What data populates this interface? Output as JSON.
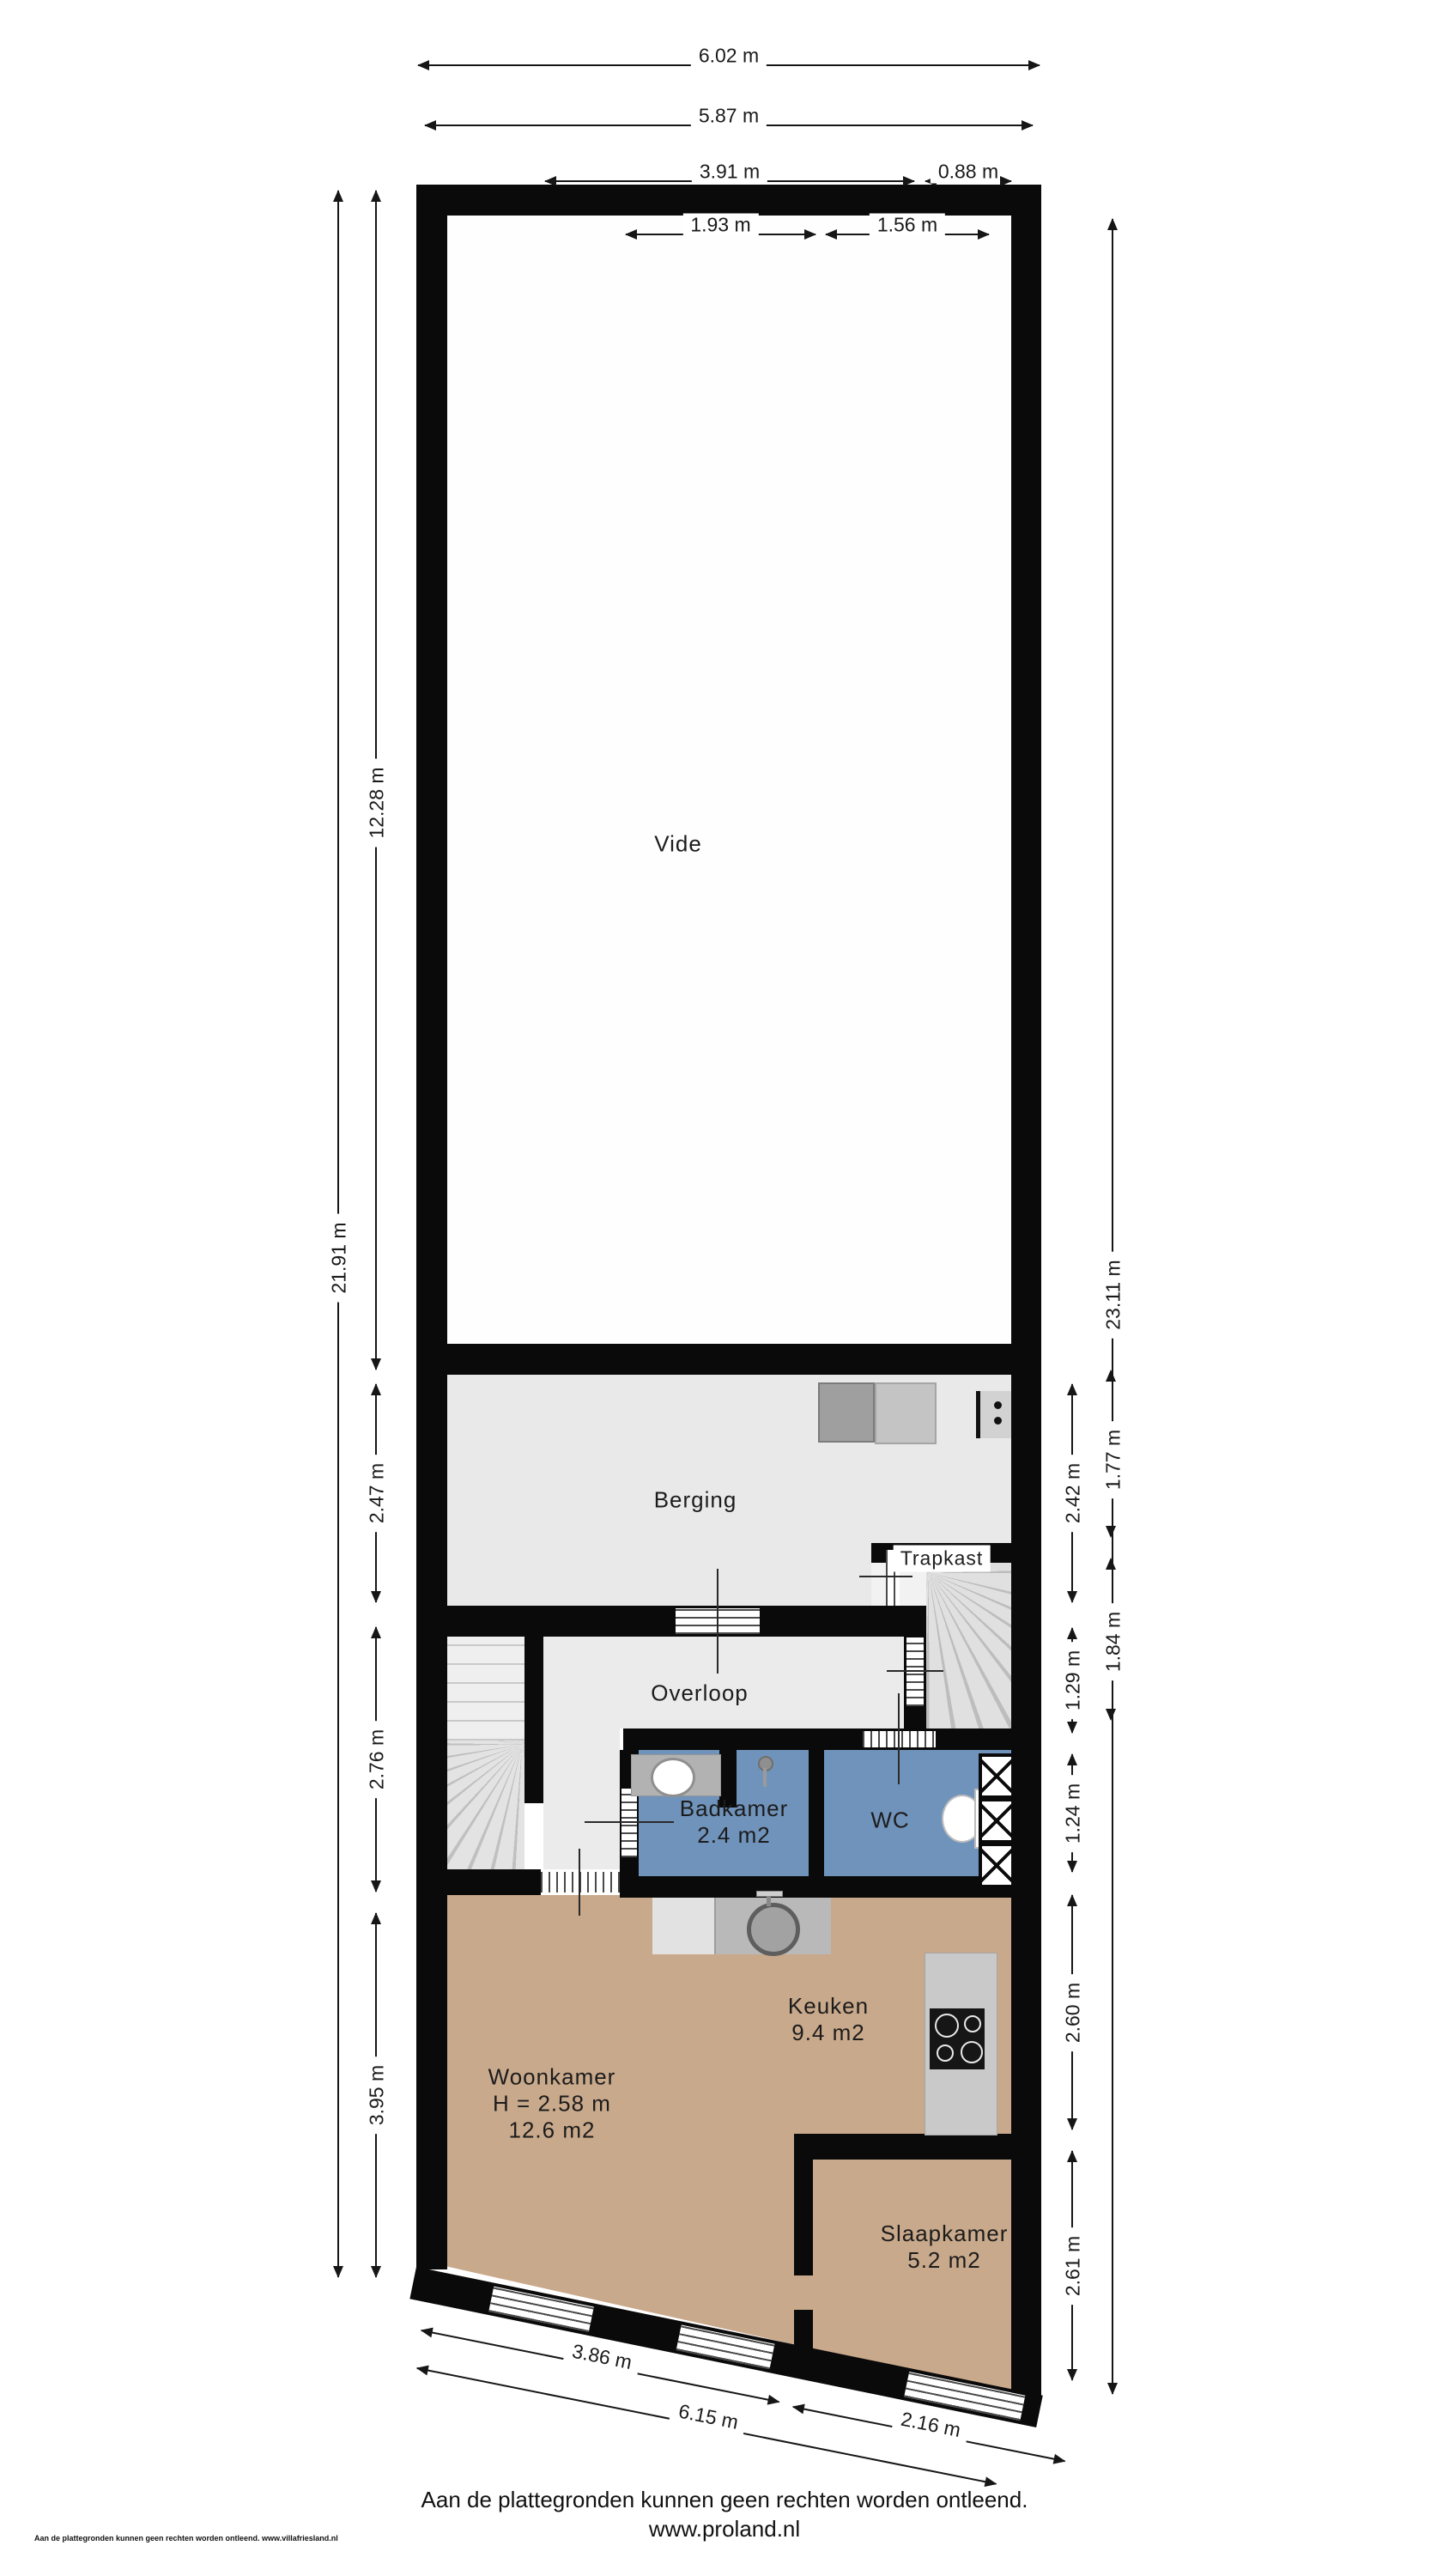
{
  "rooms": {
    "vide": {
      "name": "Vide"
    },
    "berging": {
      "name": "Berging"
    },
    "trapkast": {
      "name": "Trapkast"
    },
    "overloop": {
      "name": "Overloop"
    },
    "badkamer": {
      "name": "Badkamer",
      "area": "2.4 m2"
    },
    "wc": {
      "name": "WC"
    },
    "keuken": {
      "name": "Keuken",
      "area": "9.4 m2"
    },
    "woonkamer": {
      "name": "Woonkamer",
      "ceiling_height": "H = 2.58 m",
      "area": "12.6 m2"
    },
    "slaapkamer": {
      "name": "Slaapkamer",
      "area": "5.2 m2"
    }
  },
  "dimensions": {
    "top": {
      "d1": "6.02 m",
      "d2": "5.87 m",
      "d3": "3.91 m",
      "d4": "0.88 m",
      "d5": "1.93 m",
      "d6": "1.56 m"
    },
    "left": {
      "total": "21.91 m",
      "vide": "12.28 m",
      "berging": "2.47 m",
      "overloop": "2.76 m",
      "woonkamer": "3.95 m"
    },
    "right": {
      "total": "23.11 m",
      "seg1": "1.77 m",
      "seg2": "1.84 m",
      "berging": "2.42 m",
      "overloop": "1.29 m",
      "badkamer": "1.24 m",
      "keuken": "2.60 m",
      "slaapkamer": "2.61 m"
    },
    "bottom": {
      "woonkamer": "3.86 m",
      "slaapkamer": "2.16 m",
      "total": "6.15 m"
    }
  },
  "footer": {
    "disclaimer": "Aan de plattegronden kunnen geen rechten worden ontleend.",
    "website": "www.proland.nl",
    "small_print": "Aan de plattegronden kunnen geen rechten worden ontleend. www.villafriesland.nl"
  },
  "colors": {
    "wall": "#0a0a0a",
    "floor_storage": "#e9e9e9",
    "floor_wet": "#7093bb",
    "floor_living": "#c9a98b"
  }
}
